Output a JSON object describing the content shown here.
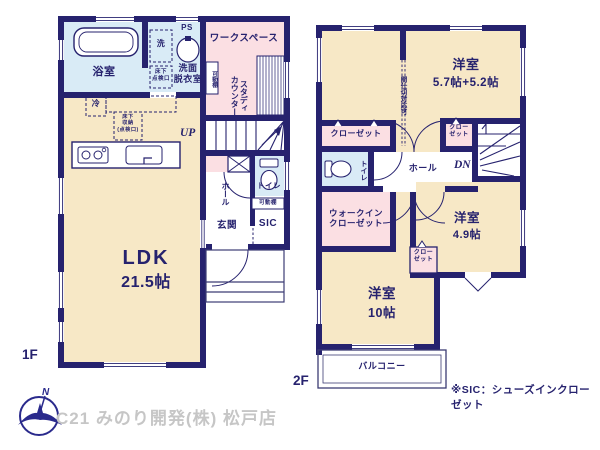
{
  "footer": {
    "company": "C21 みのり開発(株) 松戸店",
    "compass_n": "N"
  },
  "notes": {
    "sic": "※SIC：シューズインクローゼット"
  },
  "colors": {
    "wall": "#26226e",
    "room_beige": "#f7e8c6",
    "room_pink": "#fbdfe3",
    "room_blue": "#d9ebf6",
    "footer_text": "#c6c6c6"
  },
  "f1": {
    "floor": "1F",
    "bath": "浴室",
    "wash": "洗",
    "ps": "PS",
    "washroom": "洗面\n脱衣室",
    "workspace": "ワークスペース",
    "study": "スタディ\nカウンター",
    "kadoudana": "可動棚",
    "up": "UP",
    "fridge": "冷",
    "underfloor1": "床下\n点検口",
    "underfloor2": "床下\n収納\n(点検口)",
    "hall": "ホール",
    "toilet": "トイレ",
    "kadoudana2": "可動棚",
    "genkan": "玄関",
    "sic": "SIC",
    "ldk": "LDK",
    "ldk_size": "21.5帖"
  },
  "f2": {
    "floor": "2F",
    "partition": "間仕切対応可",
    "room_a": "洋室",
    "room_a_size": "5.7帖+5.2帖",
    "closet": "クローゼット",
    "closet_s": "クロー\nゼット",
    "toilet": "トイレ",
    "hall": "ホール",
    "dn": "DN",
    "wic": "ウォークイン\nクローゼット",
    "room_b": "洋室",
    "room_b_size": "4.9帖",
    "room_c": "洋室",
    "room_c_size": "10帖",
    "balcony": "バルコニー"
  }
}
